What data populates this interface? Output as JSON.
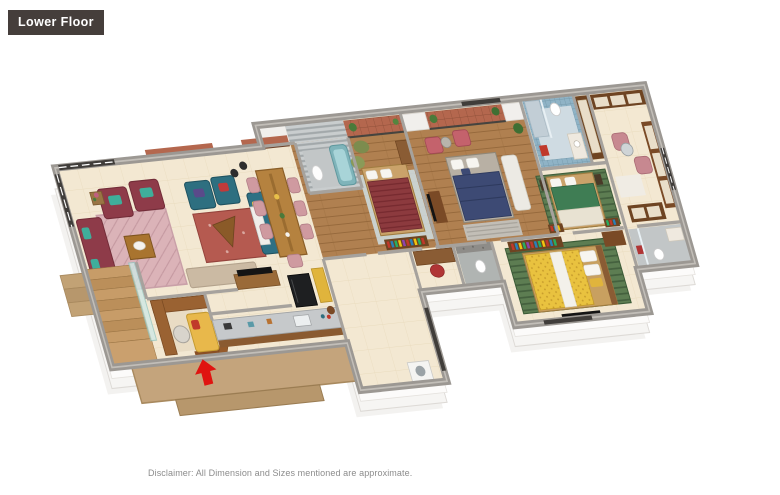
{
  "floor_label": {
    "text": "Lower Floor"
  },
  "disclaimer": {
    "text": "Disclaimer: All Dimension and Sizes mentioned are approximate."
  },
  "floor_plan": {
    "type": "3d-isometric-floor-plan",
    "palette": {
      "label_bg": "#453e3b",
      "label_text": "#ffffff",
      "disclaimer_text": "#8c8c8c",
      "wall_top": "#9c9893",
      "wall_face": "#fbfaf9",
      "floor_tile": "#f3e8d2",
      "wood_floor": "#b08050",
      "balcony_tile": "#b4674e",
      "bathroom_mosaic": "#8fb3c6",
      "sofa_maroon": "#8e3b49",
      "armchair_teal": "#2e6f80",
      "dining_chair_pink": "#cf9aa0",
      "bed_maroon": "#8c3a3e",
      "bed_navy": "#3d4a74",
      "bed_green": "#3f7d54",
      "bed_yellow": "#e9c23f",
      "rug_pink": "#dbb3b8",
      "platform_tan": "#c4a47c",
      "entry_arrow": "#e01410"
    }
  }
}
